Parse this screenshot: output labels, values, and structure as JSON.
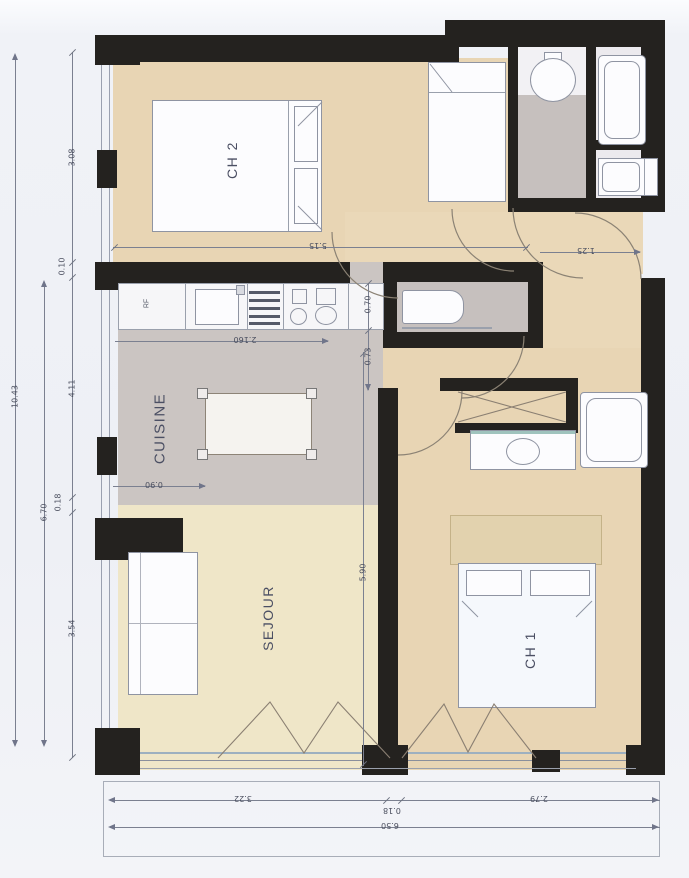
{
  "rooms": {
    "ch2": "CH 2",
    "cuisine": "CUISINE",
    "sejour": "SEJOUR",
    "ch1": "CH 1"
  },
  "appliances": {
    "fridge": "RF"
  },
  "dims": {
    "outer_height": "10.43",
    "inner_height": "6.70",
    "ch2_h": "3.08",
    "gap_top": "0.10",
    "cuisine_h": "4.11",
    "gap_mid": "0.18",
    "sejour_h": "3.54",
    "ch2_w": "5.15",
    "entry": "1.25",
    "counter_w": "2.160",
    "counter_d": "0.70",
    "pass_w": "0.73",
    "island": "0.90",
    "ch1_h": "5.90",
    "sejour_w": "3.22",
    "wall_w": "0.18",
    "ch1_w": "2.79",
    "total_w": "6.50"
  },
  "colors": {
    "wall": "#24221f",
    "floor_beige": "#e8d5b4",
    "floor_cream": "#efe6c8",
    "floor_gray": "#cbc5c2",
    "dim_line": "#7b8090"
  }
}
